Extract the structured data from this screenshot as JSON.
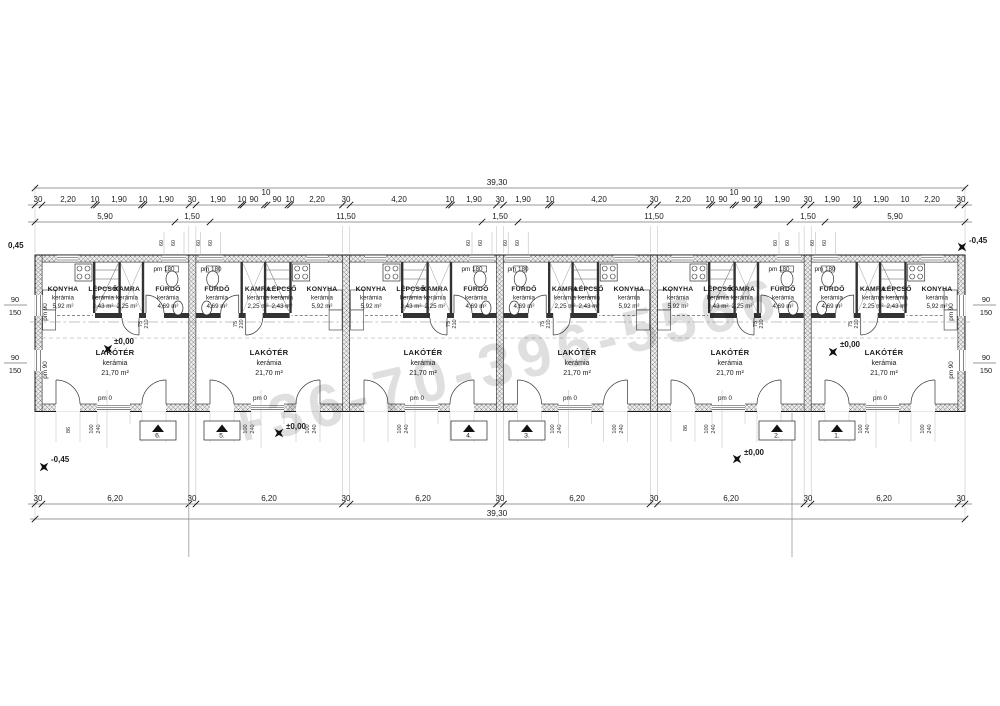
{
  "watermark": "+36-70-396-5566",
  "levels": {
    "zero": "±0,00",
    "minus": "-0,45",
    "topleft": "0,45",
    "topright": "-0,45"
  },
  "pm": {
    "p0": "pm 0",
    "p180": "pm 180",
    "p90": "pm 90"
  },
  "rooms": {
    "konyha": {
      "name": "KONYHA",
      "mat": "kerámia",
      "area": "5,92 m²"
    },
    "lepcso": {
      "name": "LÉPCSŐ",
      "mat": "kerámia",
      "area": "2,43 m²"
    },
    "kamra": {
      "name": "KAMRA",
      "mat": "kerámia",
      "area": "2,25 m²"
    },
    "furdo": {
      "name": "FÜRDŐ",
      "mat": "kerámia",
      "area": "4,69 m²"
    },
    "lakoter": {
      "name": "LAKÓTÉR",
      "mat": "kerámia",
      "area": "21,70 m²"
    }
  },
  "units": [
    "6.",
    "5.",
    "4.",
    "3.",
    "2.",
    "1."
  ],
  "dims": {
    "total": "39,30",
    "top2": [
      "30",
      "2,20",
      "10",
      "1,90",
      "10",
      "1,90",
      "30",
      "1,90",
      "10",
      "90",
      "10",
      "90",
      "10",
      "2,20",
      "30",
      "4,20",
      "10",
      "1,90",
      "30",
      "1,90",
      "10",
      "4,20",
      "30",
      "2,20",
      "10",
      "90",
      "10",
      "90",
      "10",
      "1,90",
      "30",
      "1,90",
      "10",
      "1,90",
      "10",
      "2,20",
      "30"
    ],
    "top3": [
      "5,90",
      "1,50",
      "11,50",
      "1,50",
      "11,50",
      "1,50",
      "5,90"
    ],
    "bottom": [
      "30",
      "6,20",
      "30",
      "6,20",
      "30",
      "6,20",
      "30",
      "6,20",
      "30",
      "6,20",
      "30",
      "6,20",
      "30"
    ],
    "w60": "60",
    "w90": "90",
    "w150": "150",
    "d100": "100",
    "d240": "240",
    "d86": "86",
    "d75": "75",
    "d210": "210"
  }
}
